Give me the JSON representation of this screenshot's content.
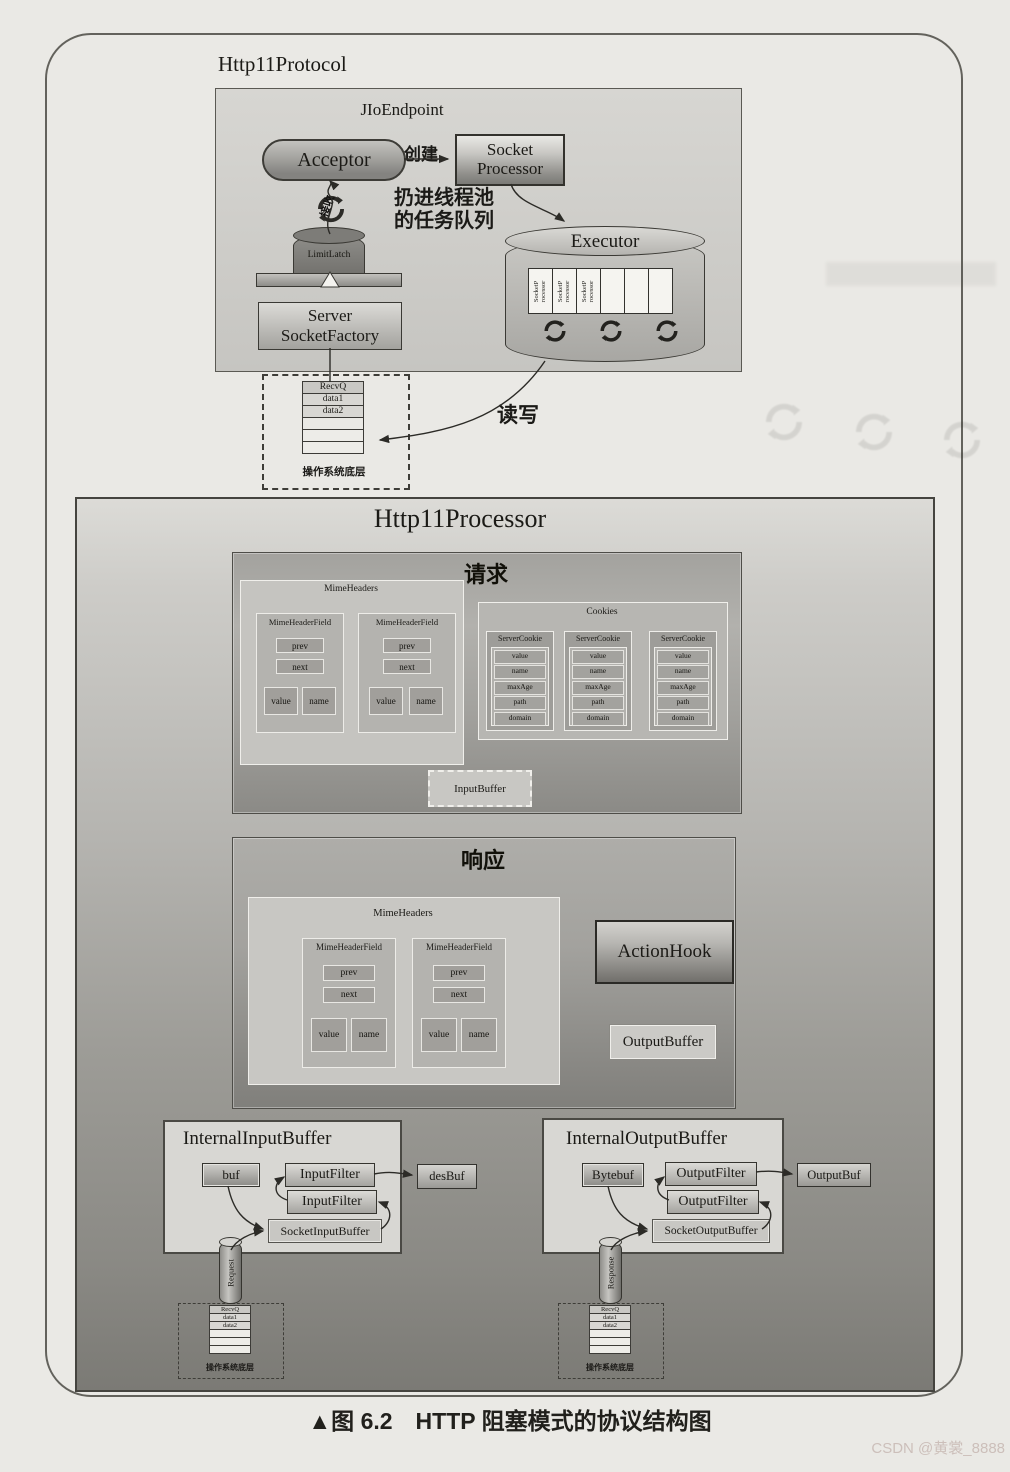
{
  "page": {
    "caption": "▲图 6.2　HTTP 阻塞模式的协议结构图",
    "watermark": "CSDN @黄裳_8888"
  },
  "protocol": {
    "title": "Http11Protocol",
    "endpoint": {
      "title": "JIoEndpoint",
      "acceptor_label": "Acceptor",
      "create_label": "创建",
      "socket_processor_line1": "Socket",
      "socket_processor_line2": "Processor",
      "queue_label_line1": "扔进线程池",
      "queue_label_line2": "的任务队列",
      "accept_label": "接收",
      "limit_latch_label": "LimitLatch",
      "ssf_line1": "Server",
      "ssf_line2": "SocketFactory",
      "executor": {
        "title": "Executor",
        "slots": [
          "SocketP rocessor",
          "SocketP rocessor",
          "SocketP rocessor",
          "",
          "",
          ""
        ]
      }
    },
    "rw_label": "读写",
    "os_box": {
      "label": "操作系统底层",
      "rows": [
        "RecvQ",
        "data1",
        "data2",
        "",
        "",
        ""
      ]
    }
  },
  "processor": {
    "title": "Http11Processor",
    "request": {
      "title": "请求",
      "mime_headers": {
        "title": "MimeHeaders",
        "fields": [
          {
            "title": "MimeHeaderField",
            "prev": "prev",
            "next": "next",
            "value": "value",
            "name": "name"
          },
          {
            "title": "MimeHeaderField",
            "prev": "prev",
            "next": "next",
            "value": "value",
            "name": "name"
          }
        ]
      },
      "cookies": {
        "title": "Cookies",
        "items": [
          {
            "title": "ServerCookie",
            "rows": [
              "value",
              "name",
              "maxAge",
              "path",
              "domain"
            ]
          },
          {
            "title": "ServerCookie",
            "rows": [
              "value",
              "name",
              "maxAge",
              "path",
              "domain"
            ]
          },
          {
            "title": "ServerCookie",
            "rows": [
              "value",
              "name",
              "maxAge",
              "path",
              "domain"
            ]
          }
        ]
      },
      "input_buffer_label": "InputBuffer"
    },
    "response": {
      "title": "响应",
      "mime_headers": {
        "title": "MimeHeaders",
        "fields": [
          {
            "title": "MimeHeaderField",
            "prev": "prev",
            "next": "next",
            "value": "value",
            "name": "name"
          },
          {
            "title": "MimeHeaderField",
            "prev": "prev",
            "next": "next",
            "value": "value",
            "name": "name"
          }
        ]
      },
      "action_hook_label": "ActionHook",
      "output_buffer_label": "OutputBuffer"
    },
    "internal_input": {
      "title": "InternalInputBuffer",
      "buf_label": "buf",
      "filter1": "InputFilter",
      "filter2": "InputFilter",
      "socket_buffer_label": "SocketInputBuffer",
      "dest_label": "desBuf",
      "pipe_label": "Request",
      "os_box": {
        "label": "操作系统底层",
        "rows": [
          "RecvQ",
          "data1",
          "data2",
          "",
          "",
          ""
        ]
      }
    },
    "internal_output": {
      "title": "InternalOutputBuffer",
      "buf_label": "Bytebuf",
      "filter1": "OutputFilter",
      "filter2": "OutputFilter",
      "socket_buffer_label": "SocketOutputBuffer",
      "dest_label": "OutputBuf",
      "pipe_label": "Response",
      "os_box": {
        "label": "操作系统底层",
        "rows": [
          "RecvQ",
          "data1",
          "data2",
          "",
          "",
          ""
        ]
      }
    }
  }
}
